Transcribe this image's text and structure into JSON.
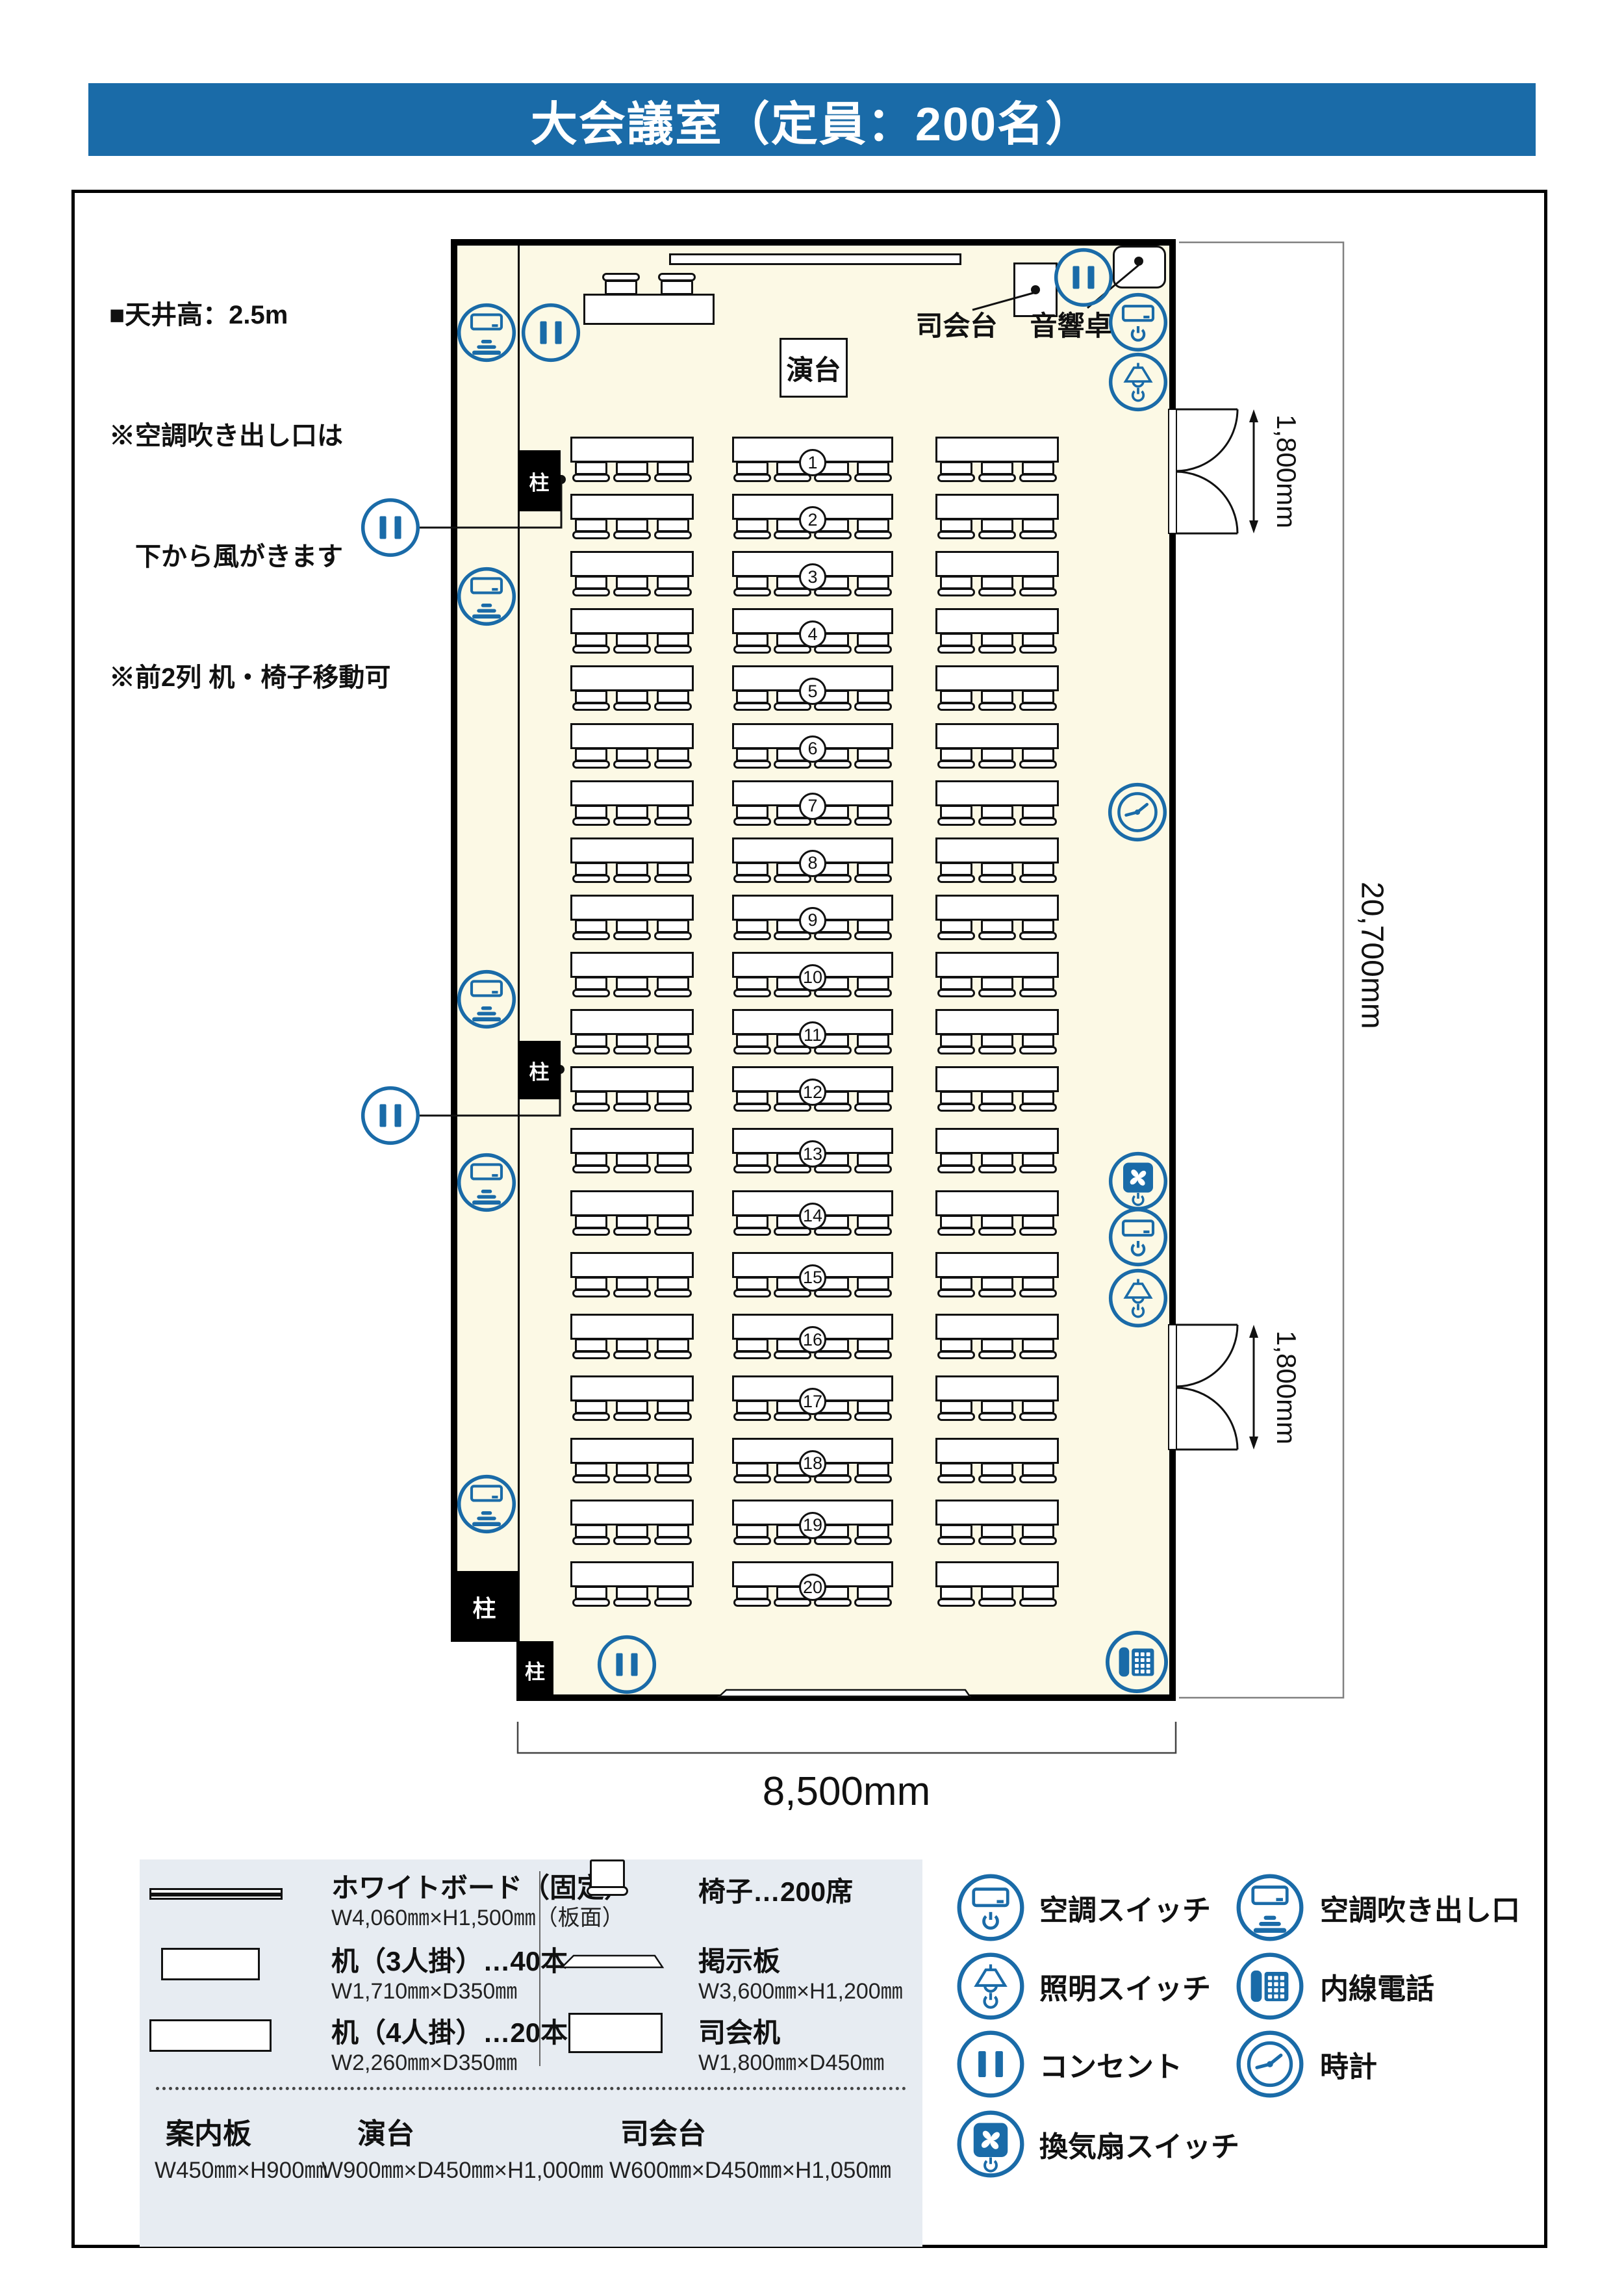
{
  "title": "大会議室（定員：200名）",
  "notes": {
    "line1": "■天井高：2.5m",
    "line2": "※空調吹き出し口は",
    "line3": "　下から風がきます",
    "line4": "※前2列 机・椅子移動可"
  },
  "room": {
    "pillar_label": "柱",
    "lectern_label": "演台",
    "mc_stand_label": "司会台",
    "sound_desk_label": "音響卓"
  },
  "rows": {
    "count": 20,
    "numbers": [
      1,
      2,
      3,
      4,
      5,
      6,
      7,
      8,
      9,
      10,
      11,
      12,
      13,
      14,
      15,
      16,
      17,
      18,
      19,
      20
    ]
  },
  "dimensions": {
    "door_width": "1,800mm",
    "room_depth": "20,700mm",
    "room_width": "8,500mm"
  },
  "legend": {
    "items": [
      {
        "name": "ホワイトボード（固定）",
        "spec": "W4,060㎜×H1,500㎜（板面）"
      },
      {
        "name": "机（3人掛）…40本",
        "spec": "W1,710㎜×D350㎜"
      },
      {
        "name": "机（4人掛）…20本",
        "spec": "W2,260㎜×D350㎜"
      },
      {
        "name": "椅子…200席",
        "spec": ""
      },
      {
        "name": "掲示板",
        "spec": "W3,600㎜×H1,200㎜"
      },
      {
        "name": "司会机",
        "spec": "W1,800㎜×D450㎜"
      }
    ],
    "bottom_items": [
      {
        "name": "案内板",
        "spec": "W450㎜×H900㎜"
      },
      {
        "name": "演台",
        "spec": "W900㎜×D450㎜×H1,000㎜"
      },
      {
        "name": "司会台",
        "spec": "W600㎜×D450㎜×H1,050㎜"
      }
    ]
  },
  "icon_legend": {
    "col_a": [
      {
        "icon": "ac-switch",
        "label": "空調スイッチ"
      },
      {
        "icon": "light-switch",
        "label": "照明スイッチ"
      },
      {
        "icon": "outlet",
        "label": "コンセント"
      },
      {
        "icon": "fan-switch",
        "label": "換気扇スイッチ"
      }
    ],
    "col_b": [
      {
        "icon": "ac-vent",
        "label": "空調吹き出し口"
      },
      {
        "icon": "phone",
        "label": "内線電話"
      },
      {
        "icon": "clock",
        "label": "時計"
      }
    ]
  },
  "colors": {
    "accent": "#1A6BA8",
    "title_bg": "#1A6BA8",
    "title_text": "#FFFFFF",
    "floor": "#FCF9E5",
    "wall": "#000000",
    "legend_bg": "#E7ECF2"
  }
}
